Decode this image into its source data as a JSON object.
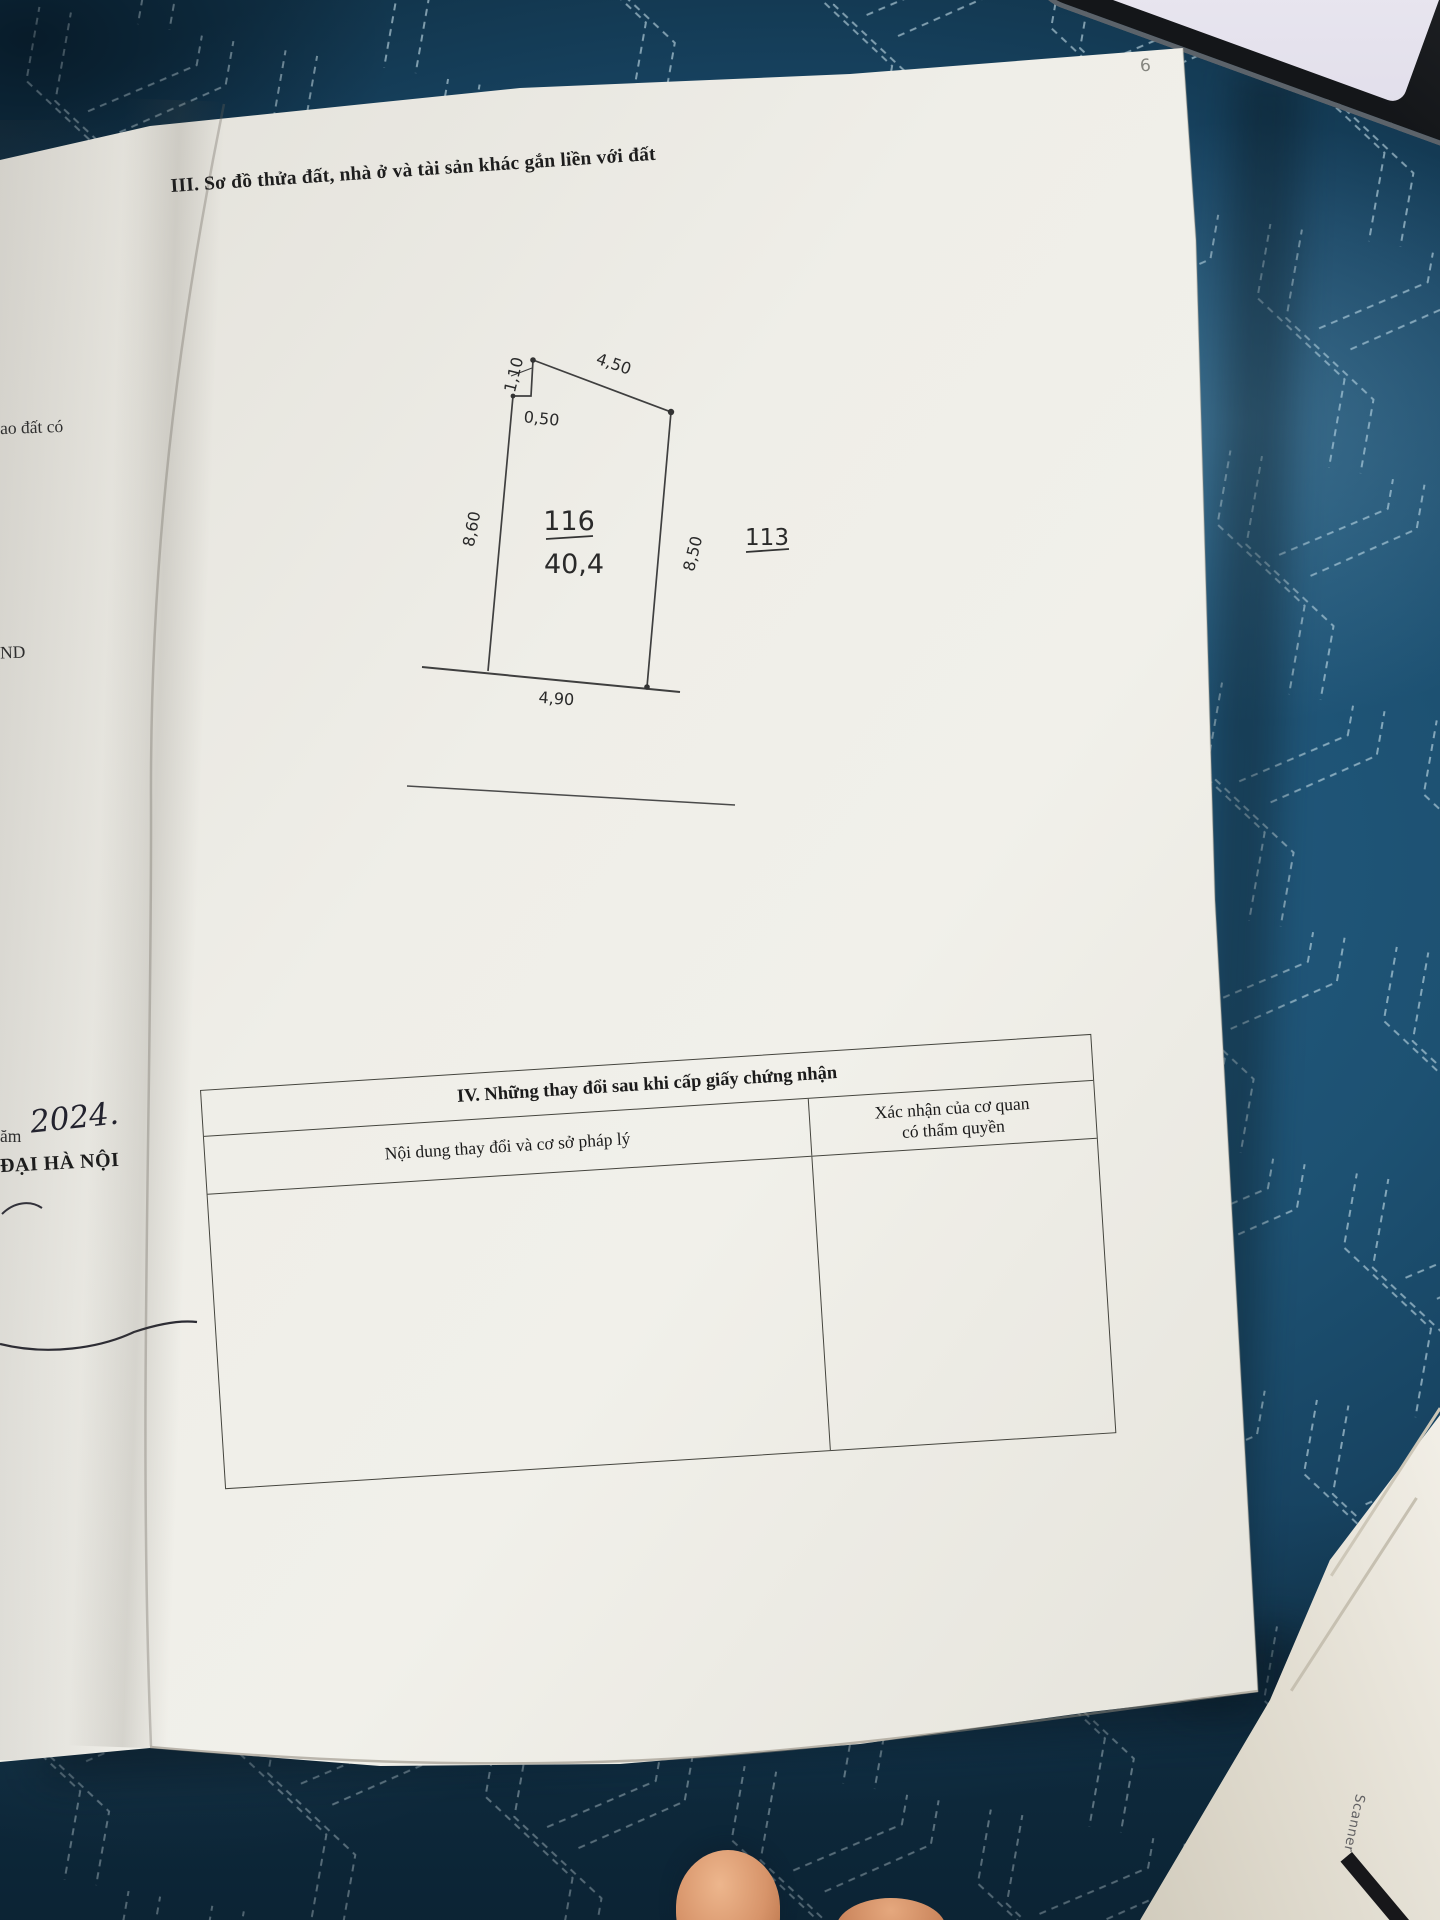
{
  "page": {
    "number": "6",
    "section3_title": "III. Sơ đồ thửa đất, nhà ở và tài sản khác gắn liền với đất"
  },
  "left_page": {
    "fragment_top": "ao đất có",
    "fragment_mid": "ND",
    "fragment_year_prefix": "ăm",
    "fragment_year_hand": "2024.",
    "fragment_org": "ĐẠI HÀ NỘI"
  },
  "diagram": {
    "plot_number": "116",
    "plot_area": "40,4",
    "adjacent_plot": "113",
    "dim_top_notch": "1,10",
    "dim_top_edge": "4,50",
    "dim_step": "0,50",
    "dim_left_edge": "8,60",
    "dim_right_edge": "8,50",
    "dim_bottom_edge": "4,90"
  },
  "table": {
    "section4_title": "IV. Những thay đổi sau khi cấp giấy chứng nhận",
    "col_left_header": "Nội dung thay đổi và cơ sở pháp lý",
    "col_right_header_line1": "Xác nhận của cơ quan",
    "col_right_header_line2": "có thẩm quyền"
  },
  "artifacts": {
    "scanner_watermark": "Scanner"
  },
  "colors": {
    "paper": "#eceae3",
    "blanket": "#1d5273",
    "stitch": "#c7dfe9",
    "ink": "#1c1c1c",
    "phone": "#17191d"
  }
}
